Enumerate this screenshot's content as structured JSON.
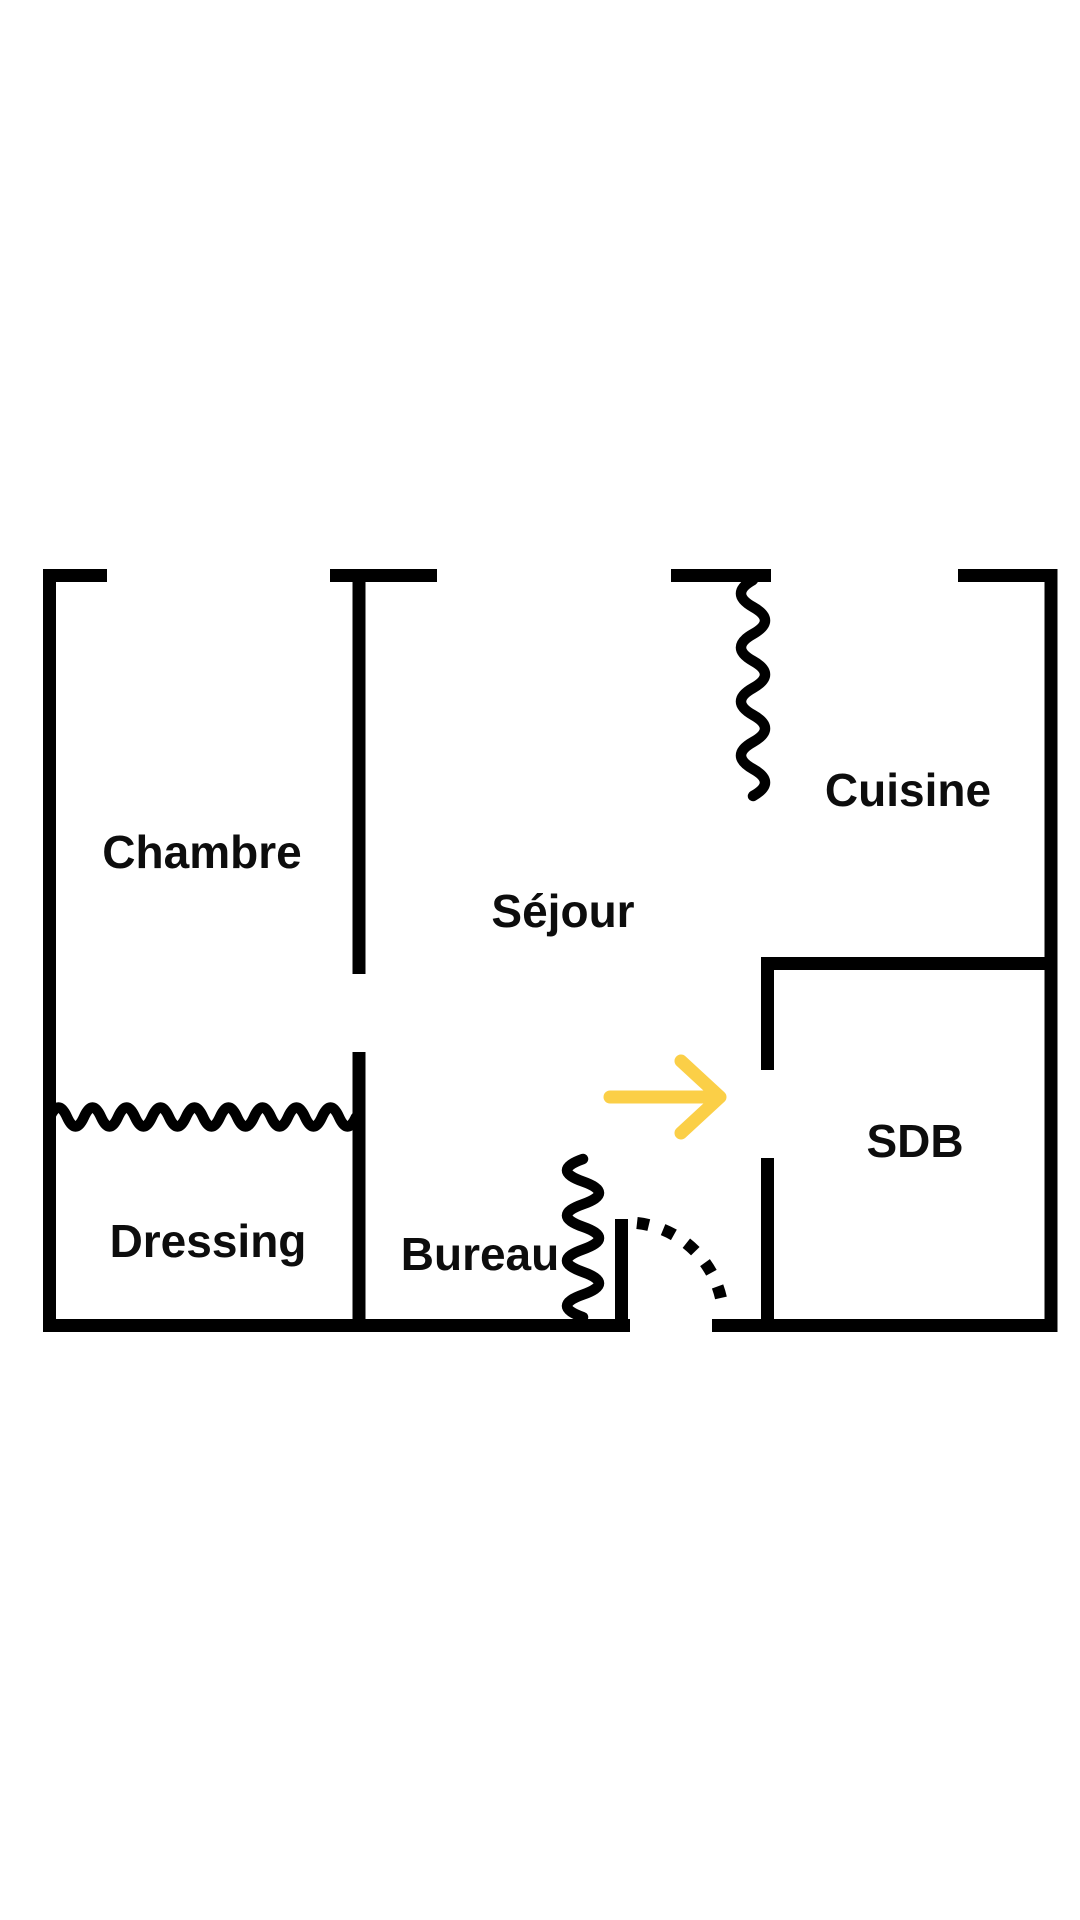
{
  "colors": {
    "background": "#ffffff",
    "wall": "#000000",
    "text": "#0d0d0d",
    "arrow": "#fbcf47"
  },
  "rooms": [
    {
      "name": "chambre",
      "label": "Chambre"
    },
    {
      "name": "sejour",
      "label": "Séjour"
    },
    {
      "name": "cuisine",
      "label": "Cuisine"
    },
    {
      "name": "dressing",
      "label": "Dressing"
    },
    {
      "name": "bureau",
      "label": "Bureau"
    },
    {
      "name": "sdb",
      "label": "SDB"
    }
  ]
}
